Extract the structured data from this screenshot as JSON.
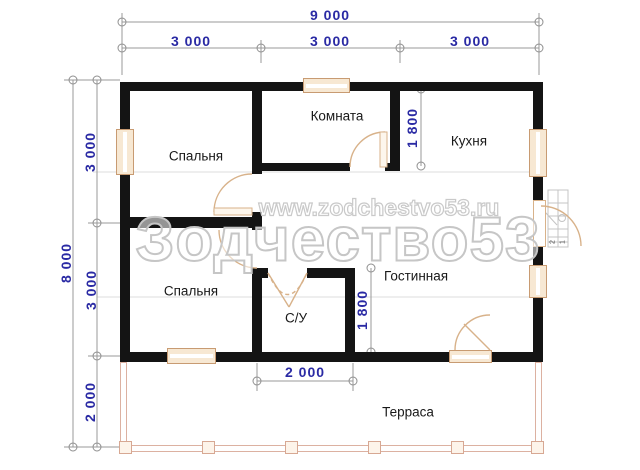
{
  "rooms": {
    "bedroom1": "Спальня",
    "inner_room": "Комната",
    "kitchen": "Кухня",
    "bedroom2": "Спальня",
    "living_room": "Гостинная",
    "bathroom": "С/У",
    "terrace": "Терраса"
  },
  "dims": {
    "total_width": "9 000",
    "top": [
      "3 000",
      "3 000",
      "3 000"
    ],
    "total_height": "8 000",
    "left": [
      "3 000",
      "3 000",
      "2 000"
    ],
    "kitchen_depth": "1 800",
    "living_depth": "1 800",
    "bathroom_width": "2 000"
  },
  "steps": [
    "2",
    "1"
  ],
  "watermark": {
    "brand": "Зодчество53",
    "site": "www.zodchestvo53.ru"
  },
  "colors": {
    "wall": "#141414",
    "dim_text": "#2a2aa4",
    "dim_line": "#8f8f8f",
    "window_fill": "#f7e8d3",
    "window_border": "#c89b72",
    "door": "#d8b28a",
    "terrace": "#dcb1a1",
    "watermark": "#c6c6c6"
  }
}
